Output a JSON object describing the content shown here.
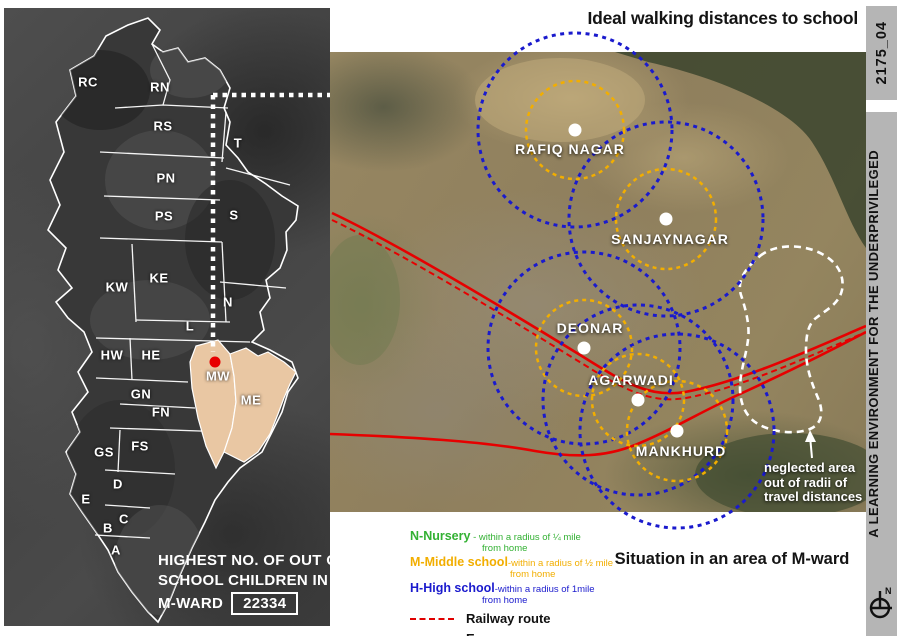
{
  "titles": {
    "ideal": "Ideal walking distances to school",
    "situation": "Situation in an area of M-ward"
  },
  "sidebar": {
    "code": "2175_04",
    "title": "A LEARNING ENVIRONMENT FOR THE UNDERPRIVILEGED",
    "compass_label": "N"
  },
  "left_map": {
    "wards": [
      {
        "label": "RC",
        "x": 88,
        "y": 82
      },
      {
        "label": "RN",
        "x": 160,
        "y": 87
      },
      {
        "label": "RS",
        "x": 163,
        "y": 126
      },
      {
        "label": "T",
        "x": 238,
        "y": 143
      },
      {
        "label": "PN",
        "x": 166,
        "y": 178
      },
      {
        "label": "PS",
        "x": 164,
        "y": 216
      },
      {
        "label": "S",
        "x": 234,
        "y": 215
      },
      {
        "label": "KE",
        "x": 159,
        "y": 278
      },
      {
        "label": "KW",
        "x": 117,
        "y": 287
      },
      {
        "label": "N",
        "x": 228,
        "y": 302
      },
      {
        "label": "L",
        "x": 190,
        "y": 326
      },
      {
        "label": "HW",
        "x": 112,
        "y": 355
      },
      {
        "label": "HE",
        "x": 151,
        "y": 355
      },
      {
        "label": "MW",
        "x": 218,
        "y": 376
      },
      {
        "label": "ME",
        "x": 251,
        "y": 400
      },
      {
        "label": "GN",
        "x": 141,
        "y": 394
      },
      {
        "label": "FN",
        "x": 161,
        "y": 412
      },
      {
        "label": "GS",
        "x": 104,
        "y": 452
      },
      {
        "label": "FS",
        "x": 140,
        "y": 446
      },
      {
        "label": "D",
        "x": 118,
        "y": 484
      },
      {
        "label": "E",
        "x": 86,
        "y": 499
      },
      {
        "label": "C",
        "x": 124,
        "y": 519
      },
      {
        "label": "B",
        "x": 108,
        "y": 528
      },
      {
        "label": "A",
        "x": 116,
        "y": 550
      }
    ],
    "caption": {
      "line1": "HIGHEST NO. OF OUT OF",
      "line2": "SCHOOL CHILDREN IN",
      "line3": "M-WARD",
      "count": "22334"
    }
  },
  "right_map": {
    "locations": [
      {
        "name": "RAFIQ NAGAR",
        "x": 575,
        "y": 130,
        "label_x": 570,
        "label_y": 141,
        "blue_r": 97,
        "orange_r": 49
      },
      {
        "name": "SANJAYNAGAR",
        "x": 666,
        "y": 219,
        "label_x": 670,
        "label_y": 231,
        "blue_r": 97,
        "orange_r": 50
      },
      {
        "name": "DEONAR",
        "x": 584,
        "y": 348,
        "label_x": 590,
        "label_y": 320,
        "blue_r": 96,
        "orange_r": 48
      },
      {
        "name": "AGARWADI",
        "x": 638,
        "y": 400,
        "label_x": 631,
        "label_y": 372,
        "blue_r": 95,
        "orange_r": 46
      },
      {
        "name": "MANKHURD",
        "x": 677,
        "y": 431,
        "label_x": 681,
        "label_y": 443,
        "blue_r": 97,
        "orange_r": 50
      }
    ],
    "annotation": {
      "line1": "neglected area",
      "line2": "out of radii of",
      "line3": "travel distances"
    }
  },
  "legend": {
    "entries": [
      {
        "key": "N-Nursery",
        "sep": " - ",
        "desc": "within a radius of ¼ mile",
        "desc2": "from home"
      },
      {
        "key": "M-Middle school",
        "sep": "-",
        "desc": "within a radius of ½ mile",
        "desc2": "from home"
      },
      {
        "key": "H-High school",
        "sep": "-",
        "desc": "within a radius of 1mile",
        "desc2": "from home"
      }
    ],
    "railway_label": "Railway route",
    "expressway_label": "Expressway"
  },
  "colors": {
    "accent_red": "#e60000",
    "high_blue": "#1a1acd",
    "middle_orange": "#f2ae00",
    "nursery_green": "#33b133",
    "mward_beige": "#e9c7a3",
    "sidebar_gray": "#b5b5b5"
  }
}
